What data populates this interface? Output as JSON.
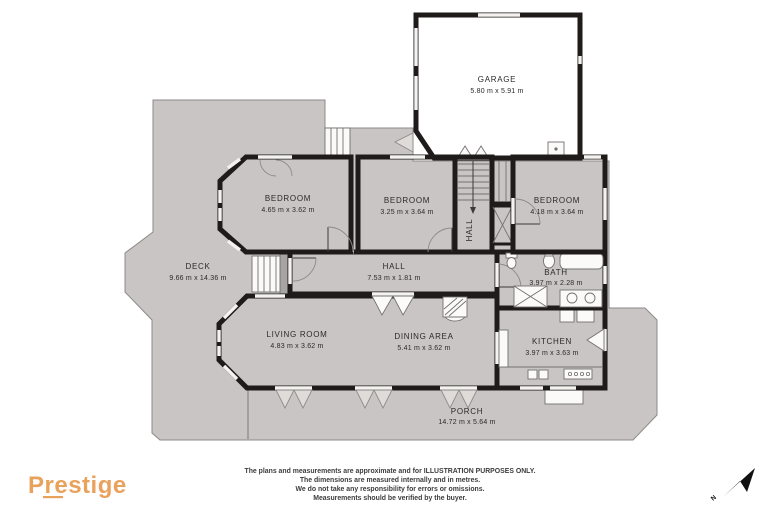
{
  "palette": {
    "outdoor": "#c9c5c4",
    "room": "#f4f3f0",
    "bedroom": "#e2a05b",
    "bath": "#9d9c9b",
    "wall": "#1e1b1a",
    "logo": "#e9a25c"
  },
  "rooms": {
    "garage": {
      "name": "GARAGE",
      "dims": "5.80 m x 5.91 m"
    },
    "bedroom1": {
      "name": "BEDROOM",
      "dims": "4.65 m x 3.62 m"
    },
    "bedroom2": {
      "name": "BEDROOM",
      "dims": "3.25 m x 3.64 m"
    },
    "bedroom3": {
      "name": "BEDROOM",
      "dims": "4.18 m x 3.64 m"
    },
    "stairhall": {
      "name": "HALL"
    },
    "hall": {
      "name": "HALL",
      "dims": "7.53 m x 1.81 m"
    },
    "bath": {
      "name": "BATH",
      "dims": "3.97 m x 2.28 m"
    },
    "living": {
      "name": "LIVING ROOM",
      "dims": "4.83 m x 3.62 m"
    },
    "dining": {
      "name": "DINING AREA",
      "dims": "5.41 m x 3.62 m"
    },
    "kitchen": {
      "name": "KITCHEN",
      "dims": "3.97 m x 3.63 m"
    },
    "deck": {
      "name": "DECK",
      "dims": "9.66 m x 14.36 m"
    },
    "porch": {
      "name": "PORCH",
      "dims": "14.72 m x 5.64 m"
    }
  },
  "footer": {
    "logo": "Prestige",
    "disclaimer_lines": [
      "The plans and measurements are approximate and for ILLUSTRATION PURPOSES ONLY.",
      "The dimensions are measured internally and in metres.",
      "We do not take any responsibility for errors or omissions.",
      "Measurements should be verified by the buyer."
    ]
  },
  "compass": {
    "label": "N"
  }
}
